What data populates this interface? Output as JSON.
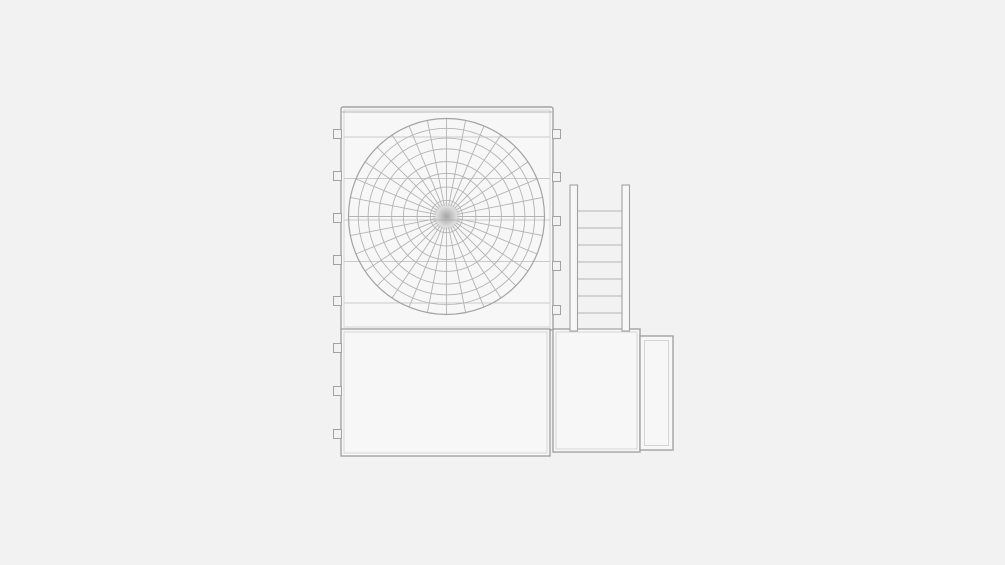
{
  "scene": {
    "description": "grayscale technical line drawing, side elevation of an air-cooled condensing unit with fan guard, service ladder and base housings",
    "background": "#f2f2f2",
    "face_fill": "#f7f7f7",
    "stroke_dark": "#a2a2a2",
    "stroke_mid": "#b4b4b4",
    "stroke_light": "#c9cbcb",
    "stroke_inner": "#d4d4d4",
    "hub_color": "#9c9c9c"
  },
  "unit": {
    "fan_section": {
      "x": 341,
      "y": 107,
      "w": 212,
      "h": 223
    },
    "fin_line_ys": [
      137,
      178.5,
      220,
      261.5,
      303
    ],
    "fan_guard": {
      "cx": 446.5,
      "cy": 216.5,
      "r": 98,
      "ring_fractions": [
        0.165,
        0.3,
        0.44,
        0.56,
        0.69,
        0.8,
        0.9,
        1.0
      ],
      "spoke_count": 32,
      "spoke_inner_r": 11,
      "hub_r": 15
    },
    "mounting_tabs": {
      "w": 8,
      "h": 9,
      "left_x": 333.5,
      "right_x": 552.5,
      "left_centers_y": [
        134,
        176,
        218,
        260,
        301,
        348,
        391,
        434
      ],
      "right_centers_y": [
        134,
        177,
        221,
        266,
        310
      ]
    },
    "ladder": {
      "rail_left_x": 570,
      "rail_right_x": 622,
      "rail_w": 7.5,
      "top_y": 185,
      "bottom_y": 331,
      "rung_ys": [
        211,
        228,
        245,
        262,
        279,
        296,
        313,
        329
      ]
    },
    "base_box": {
      "x": 341,
      "y": 329,
      "w": 209,
      "h": 127,
      "inset": 3
    },
    "side_box": {
      "x": 553,
      "y": 329,
      "w": 87,
      "h": 123,
      "inset": 3
    },
    "end_box": {
      "x": 640,
      "y": 336,
      "w": 33,
      "h": 114,
      "inset": 4.5
    }
  }
}
